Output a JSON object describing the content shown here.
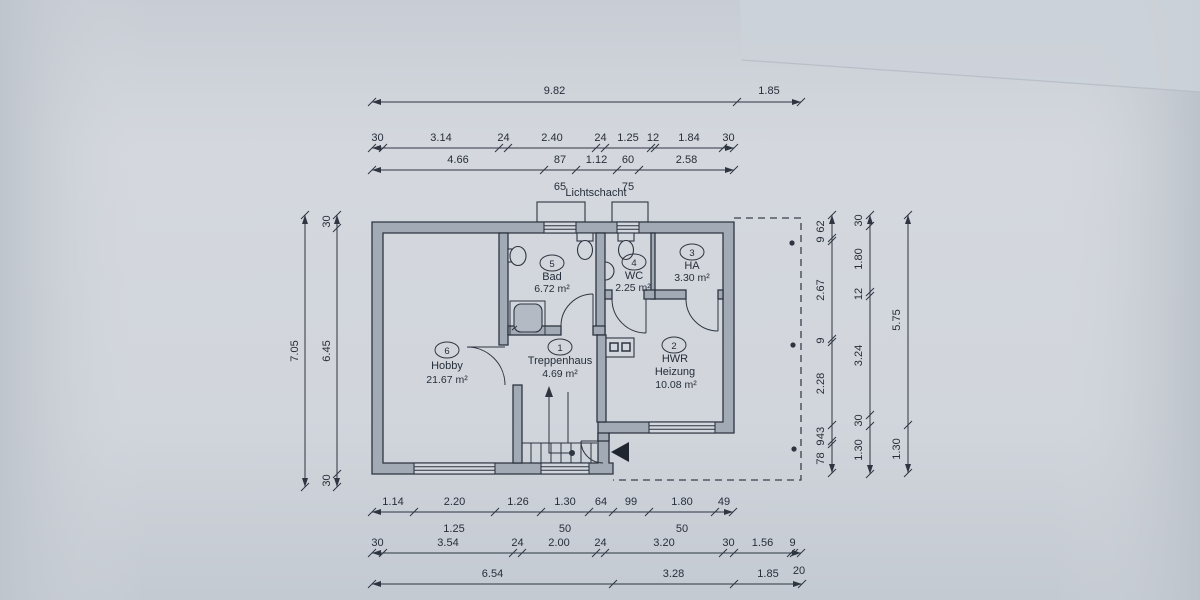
{
  "plan": {
    "lichtschacht_label": "Lichtschacht",
    "rooms": [
      {
        "number": "6",
        "name": "Hobby",
        "area": "21.67 m²"
      },
      {
        "number": "1",
        "name": "Treppenhaus",
        "area": "4.69 m²"
      },
      {
        "number": "5",
        "name": "Bad",
        "area": "6.72 m²"
      },
      {
        "number": "4",
        "name": "WC",
        "area": "2.25 m²"
      },
      {
        "number": "3",
        "name": "HA",
        "area": "3.30 m²"
      },
      {
        "number": "2",
        "name": "HWR",
        "name2": "Heizung",
        "area": "10.08 m²"
      }
    ]
  },
  "dimensions": {
    "top_row1": [
      "9.82",
      "1.85"
    ],
    "top_row2": [
      "30",
      "3.14",
      "24",
      "2.40",
      "24",
      "1.25",
      "12",
      "1.84",
      "30"
    ],
    "top_row3": [
      "4.66",
      "87",
      "1.12",
      "60",
      "2.58"
    ],
    "top_row3_sub": [
      "65",
      "75"
    ],
    "left_outer": [
      "7.05"
    ],
    "left_inner": [
      "30",
      "6.45",
      "30"
    ],
    "right_inner": [
      "62",
      "9",
      "2.67",
      "9",
      "2.28",
      "43",
      "9",
      "78"
    ],
    "right_middle": [
      "30",
      "1.80",
      "12",
      "3.24",
      "30",
      "1.30"
    ],
    "right_outer": [
      "5.75",
      "1.30"
    ],
    "bottom_row1": [
      "1.14",
      "2.20",
      "1.26",
      "1.30",
      "64",
      "99",
      "1.80",
      "49"
    ],
    "bottom_row1_sub": [
      "1.25",
      "50",
      "50"
    ],
    "bottom_row2": [
      "30",
      "3.54",
      "24",
      "2.00",
      "24",
      "3.20",
      "30",
      "1.56",
      "9"
    ],
    "bottom_row2_sub": [
      "20"
    ],
    "bottom_row3": [
      "6.54",
      "3.28",
      "1.85"
    ]
  },
  "colors": {
    "paper": "#d2d6dd",
    "wall_fill": "#a2aab5",
    "line": "#2e3541"
  }
}
